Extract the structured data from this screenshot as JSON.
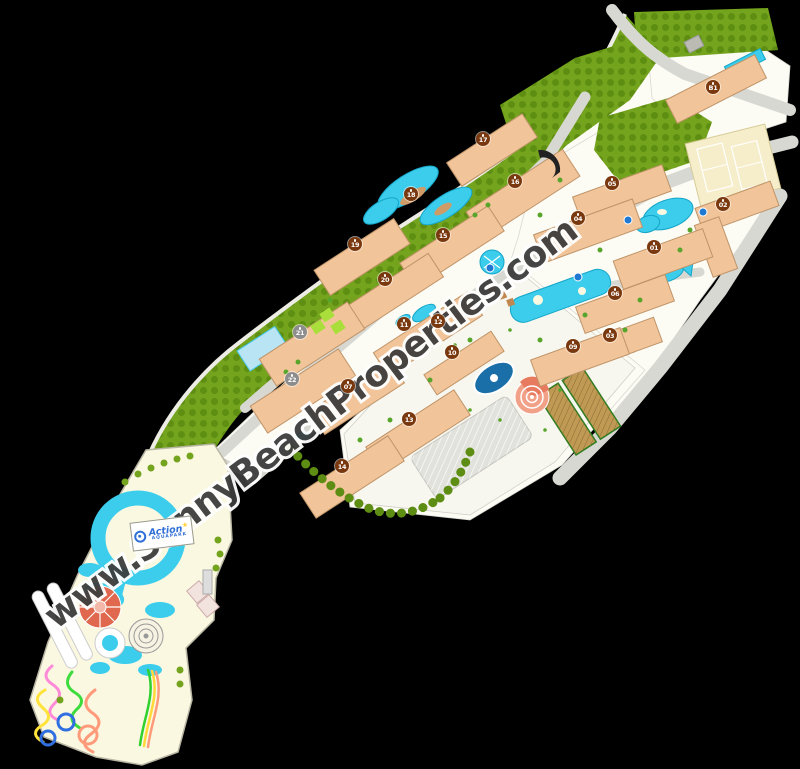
{
  "watermark": {
    "text": "www.SunnyBeachProperties.com"
  },
  "aquapark": {
    "logo_title": "Action",
    "logo_star": "★",
    "logo_subtitle": "AQUAPARK"
  },
  "colors": {
    "bg": "#000000",
    "parcel": "#fcfbf4",
    "green": "#74a41d",
    "greenDot": "#5a8a10",
    "road": "#d8d8d3",
    "bld": "#f2c49a",
    "bldStroke": "#bf9468",
    "pool": "#3ccdec",
    "poolStroke": "#14a5c8",
    "poolDark": "#1b6fa8",
    "cream": "#fbf8e2",
    "coral": "#e0684e",
    "amphi": "#f2a189",
    "markerBrown": "#79380e",
    "markerGray": "#8d8d8d",
    "wmFill": "#3d3d3d",
    "wmHalo": "#ffffff",
    "tennis": "#f6eecb",
    "parking": "#e2e2dd",
    "garden": "#c09a55",
    "hedge": "#5d8d12",
    "lime": "#aade3a",
    "logoBlue": "#2f6fd8",
    "star": "#ffd23a"
  },
  "map": {
    "markers": [
      {
        "label": "B1",
        "x": 713,
        "y": 87,
        "variant": "brown"
      },
      {
        "label": "17",
        "x": 483,
        "y": 139,
        "variant": "brown"
      },
      {
        "label": "16",
        "x": 515,
        "y": 181,
        "variant": "brown"
      },
      {
        "label": "18",
        "x": 411,
        "y": 194,
        "variant": "brown"
      },
      {
        "label": "05",
        "x": 612,
        "y": 183,
        "variant": "brown"
      },
      {
        "label": "04",
        "x": 578,
        "y": 218,
        "variant": "brown"
      },
      {
        "label": "02",
        "x": 723,
        "y": 204,
        "variant": "brown"
      },
      {
        "label": "15",
        "x": 443,
        "y": 235,
        "variant": "brown"
      },
      {
        "label": "19",
        "x": 355,
        "y": 244,
        "variant": "brown"
      },
      {
        "label": "01",
        "x": 654,
        "y": 247,
        "variant": "brown"
      },
      {
        "label": "20",
        "x": 385,
        "y": 279,
        "variant": "brown"
      },
      {
        "label": "06",
        "x": 615,
        "y": 293,
        "variant": "brown"
      },
      {
        "label": "12",
        "x": 438,
        "y": 321,
        "variant": "brown"
      },
      {
        "label": "11",
        "x": 404,
        "y": 324,
        "variant": "brown"
      },
      {
        "label": "21",
        "x": 300,
        "y": 332,
        "variant": "gray"
      },
      {
        "label": "03",
        "x": 610,
        "y": 335,
        "variant": "brown"
      },
      {
        "label": "09",
        "x": 573,
        "y": 346,
        "variant": "brown"
      },
      {
        "label": "10",
        "x": 452,
        "y": 352,
        "variant": "brown"
      },
      {
        "label": "22",
        "x": 292,
        "y": 379,
        "variant": "gray"
      },
      {
        "label": "07",
        "x": 348,
        "y": 386,
        "variant": "brown"
      },
      {
        "label": "13",
        "x": 409,
        "y": 419,
        "variant": "brown"
      },
      {
        "label": "14",
        "x": 342,
        "y": 466,
        "variant": "brown"
      }
    ],
    "poi_dots": [
      {
        "x": 703,
        "y": 212
      },
      {
        "x": 628,
        "y": 220
      },
      {
        "x": 578,
        "y": 277
      },
      {
        "x": 490,
        "y": 268
      }
    ]
  }
}
